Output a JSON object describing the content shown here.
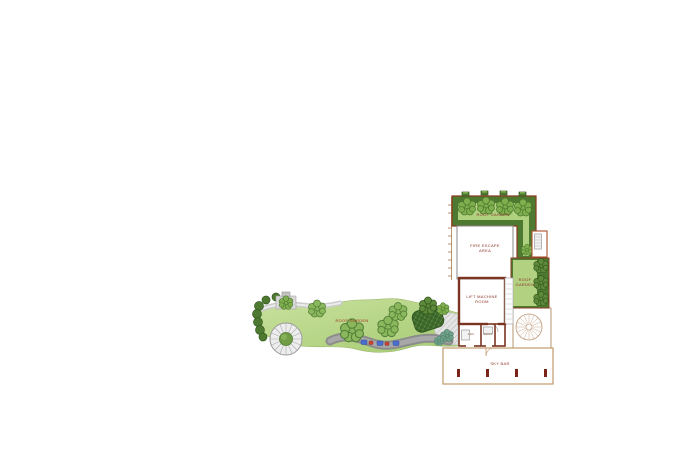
{
  "document": {
    "type": "architectural roof plan drawing",
    "background": "#ffffff"
  },
  "labels": {
    "roof_garden_top": "ROOF GARDEN",
    "fire_escape": {
      "l1": "FIRE ESCAPE",
      "l2": "AREA"
    },
    "roof_garden_right": {
      "l1": "ROOF",
      "l2": "GARDEN"
    },
    "lift_machine": {
      "l1": "LIFT MACHINE",
      "l2": "ROOM"
    },
    "room_ahu": "AHU",
    "room_duct": "DUCT",
    "sky_bar": "SKY BAR",
    "roof_garden_left": "ROOF GARDEN"
  },
  "colors": {
    "hedge_dark_green": "#4d7a30",
    "lawn_light_green": "#b2d282",
    "tree_green": "#8ab75c",
    "wall_brown": "#7a3420",
    "boundary_tan": "#bc8e62",
    "label_red": "#8a3324",
    "column_dark_red": "#7a2418",
    "path_gray": "#8c8c8c",
    "bench_blue": "#4a6fd0",
    "bench_red": "#cc4433"
  }
}
